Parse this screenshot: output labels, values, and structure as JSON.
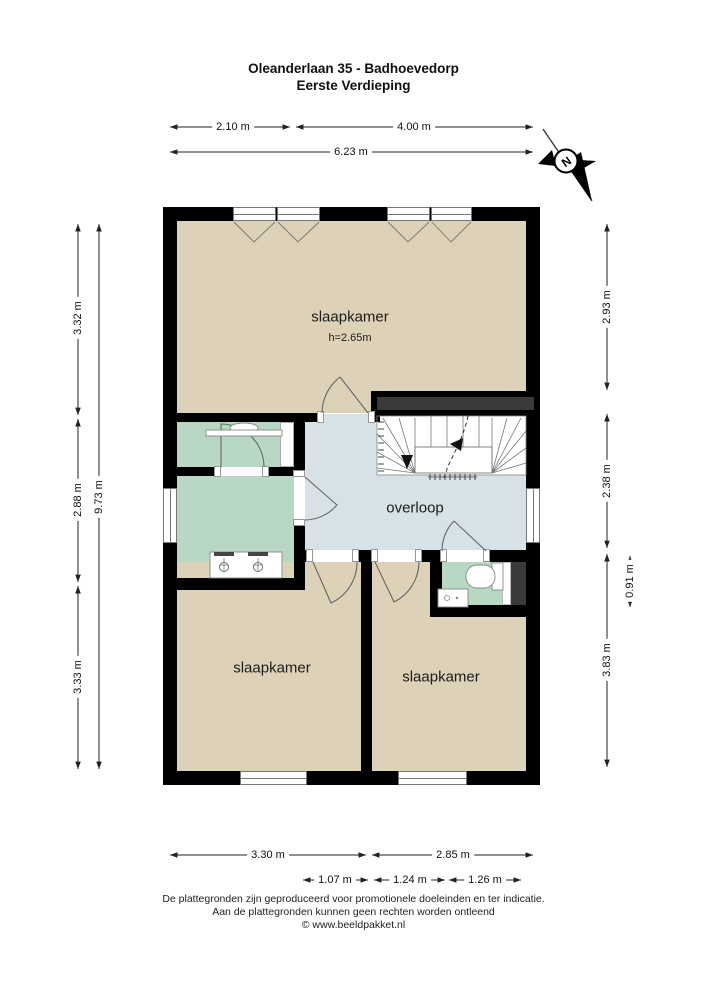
{
  "title": {
    "line1": "Oleanderlaan 35 - Badhoevedorp",
    "line2": "Eerste Verdieping"
  },
  "rooms": {
    "bedroom_top": {
      "label": "slaapkamer",
      "ceiling_height": "h=2.65m"
    },
    "landing": {
      "label": "overloop"
    },
    "bedroom_bottom_left": {
      "label": "slaapkamer"
    },
    "bedroom_bottom_right": {
      "label": "slaapkamer"
    }
  },
  "dimensions": {
    "top": {
      "seg1": "2.10 m",
      "seg2": "4.00 m",
      "total": "6.23 m"
    },
    "left": {
      "seg1": "3.32 m",
      "seg2": "2.88 m",
      "seg3": "3.33 m",
      "total": "9.73 m"
    },
    "right": {
      "seg1": "2.93 m",
      "seg2": "2.38 m",
      "seg3": "3.83 m",
      "toilet_depth": "0.91 m"
    },
    "bottom": {
      "seg1": "3.30 m",
      "seg2": "2.85 m",
      "sub1": "1.07 m",
      "sub2": "1.24 m",
      "sub3": "1.26 m"
    }
  },
  "compass": {
    "north_label": "N"
  },
  "icons": [
    "compass-north-icon",
    "stairs-icon",
    "toilet-icon",
    "hand-basin-icon",
    "double-sink-vanity-icon",
    "wall-sink-icon",
    "door-swing-icon"
  ],
  "footer": {
    "line1": "De plattegronden zijn geproduceerd voor promotionele doeleinden en ter indicatie.",
    "line2": "Aan de plattegronden kunnen geen rechten worden ontleend",
    "line3": "© www.beeldpakket.nl"
  },
  "colors": {
    "floor_beige": "#ddd1b7",
    "wet_room_green": "#b9d8c3",
    "landing_blue": "#d6e2e5",
    "wall_black": "#000000",
    "shaft_gray": "#3a3a3a"
  }
}
